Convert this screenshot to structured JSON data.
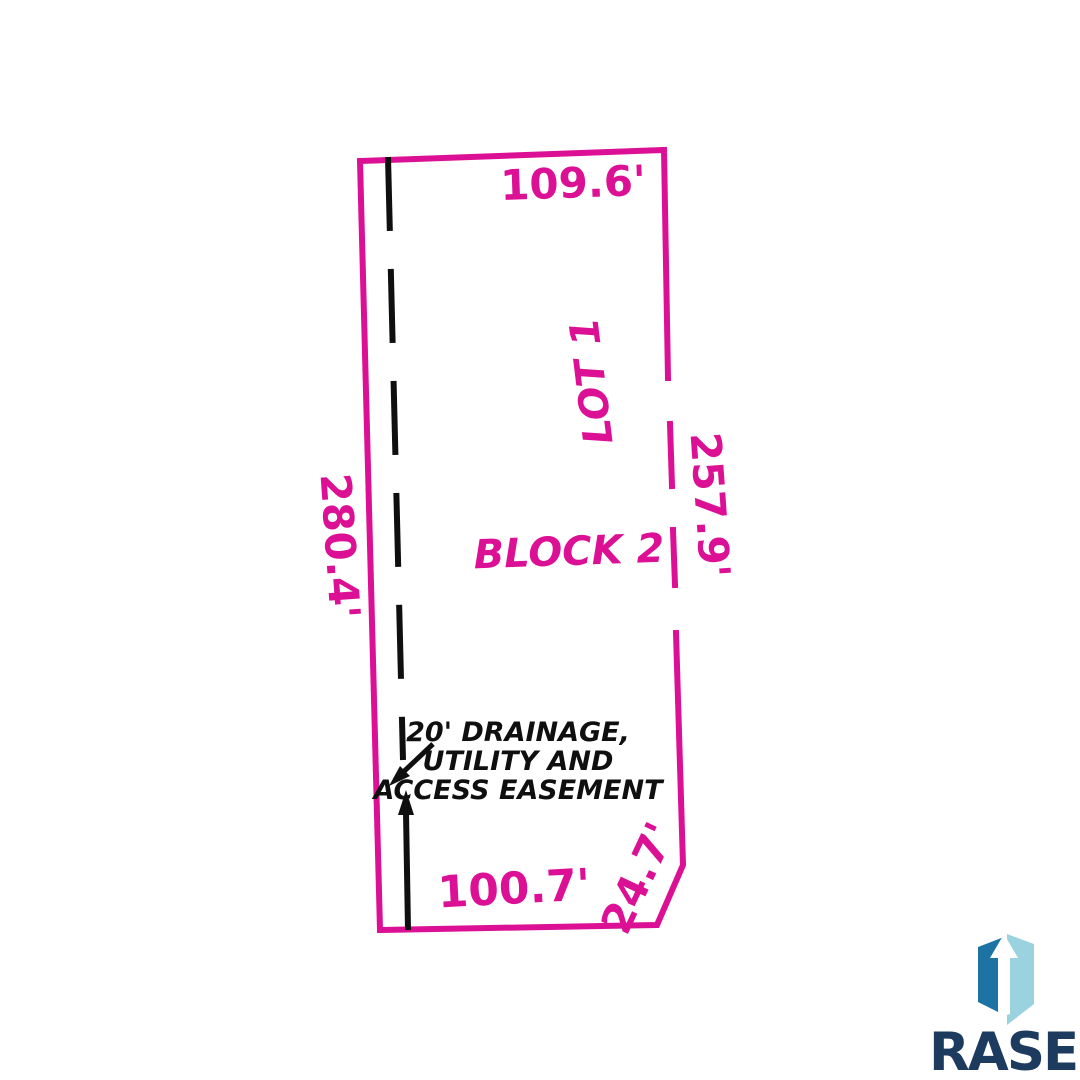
{
  "plat": {
    "lot_label": "LOT 1",
    "block_label": "BLOCK 2",
    "dimensions": {
      "top": "109.6'",
      "left": "280.4'",
      "right": "257.9'",
      "bottom": "100.7'",
      "corner": "24.7'"
    },
    "easement_note": [
      "20' DRAINAGE,",
      "UTILITY AND",
      "ACCESS EASEMENT"
    ]
  },
  "logo": {
    "name": "RASE",
    "icon": "building-arrow-icon"
  },
  "colors": {
    "background": "#ffffff",
    "boundary_magenta": "#dc1095",
    "easement_black": "#0f0f0f",
    "logo_navy": "#1d3a5f",
    "logo_blue_dark": "#1d74a4",
    "logo_blue_light": "#9ad2df"
  }
}
